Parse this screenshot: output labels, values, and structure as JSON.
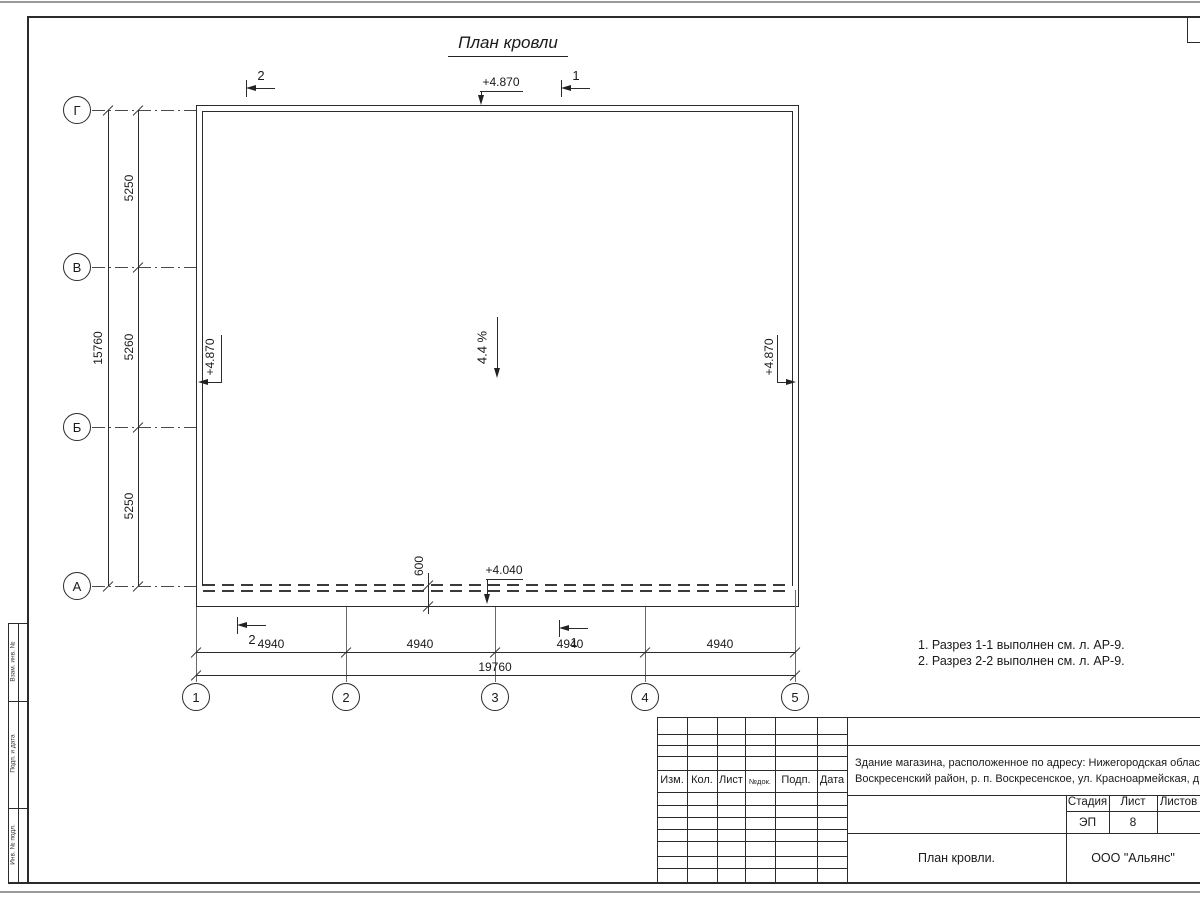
{
  "sheet": {
    "title": "План кровли",
    "notes_line1": "1. Разрез 1-1 выполнен см. л. АР-9.",
    "notes_line2": "2. Разрез 2-2 выполнен см. л. АР-9."
  },
  "plan": {
    "slope_label": "4.4 %",
    "elevation_top": "+4.870",
    "elevation_left": "+4.870",
    "elevation_right": "+4.870",
    "elevation_eaves": "+4.040",
    "overhang_dim": "600",
    "row_axes": [
      "Г",
      "В",
      "Б",
      "А"
    ],
    "col_axes": [
      "1",
      "2",
      "3",
      "4",
      "5"
    ],
    "v_dim_segments": [
      "5250",
      "5260",
      "5250"
    ],
    "v_dim_total": "15760",
    "h_dim_segments": [
      "4940",
      "4940",
      "4940",
      "4940"
    ],
    "h_dim_total": "19760",
    "section_top_left": "2",
    "section_top_right": "1",
    "section_bottom_left": "2",
    "section_bottom_right": "1"
  },
  "title_block": {
    "revision_headers": [
      "Изм.",
      "Кол.",
      "Лист",
      "№док.",
      "Подп.",
      "Дата"
    ],
    "project_line1": "Здание магазина, расположенное по адресу: Нижегородская область,",
    "project_line2": "Воскресенский район, р. п. Воскресенское, ул. Красноармейская, д. 1",
    "stage_header": "Стадия",
    "sheet_header": "Лист",
    "sheets_header": "Листов",
    "stage": "ЭП",
    "sheet_number": "8",
    "drawing_title": "План кровли.",
    "organization": "ООО \"Альянс\""
  },
  "side_stamp": {
    "labels": [
      "Взам. инв. №",
      "Подп. и дата",
      "Инв. № подл."
    ]
  }
}
